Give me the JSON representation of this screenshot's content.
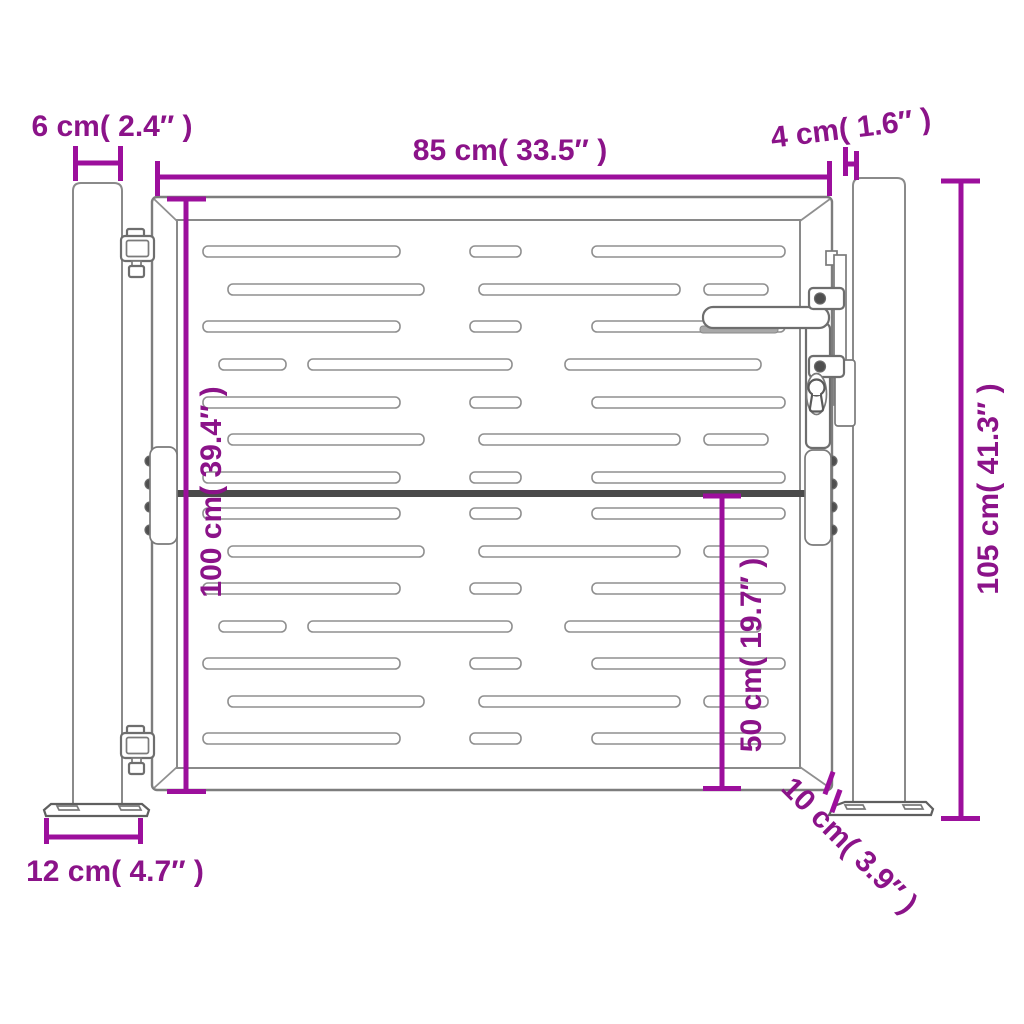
{
  "image_type": "technical dimension diagram of a metal garden gate with two posts",
  "colors": {
    "background": "#ffffff",
    "dimension_line": "#9c0f9c",
    "dimension_text": "#8b1389",
    "drawing_line": "#8a8a8a",
    "drawing_dark": "#4a4a4a"
  },
  "dimensions": {
    "post_width": "6 cm( 2.4″ )",
    "gate_width": "85 cm( 33.5″ )",
    "gate_to_post_gap": "4 cm( 1.6″ )",
    "gate_height": "100 cm( 39.4″ )",
    "post_height": "105 cm( 41.3″ )",
    "lower_section_height": "50 cm( 19.7″ )",
    "base_plate_width": "12 cm( 4.7″ )",
    "base_plate_depth": "10 cm( 3.9″ )"
  },
  "slots": {
    "height": 11,
    "types": {
      "A": [
        [
          203,
          197
        ],
        [
          470,
          51
        ],
        [
          592,
          193
        ]
      ],
      "B": [
        [
          228,
          196
        ],
        [
          479,
          201
        ],
        [
          704,
          64
        ]
      ],
      "C": [
        [
          219,
          67
        ],
        [
          308,
          204
        ],
        [
          565,
          196
        ]
      ]
    },
    "sequence": [
      "A",
      "B",
      "A",
      "C",
      "A",
      "B",
      "A"
    ],
    "row_y_upper": [
      246,
      284,
      321,
      359,
      397,
      434,
      472
    ],
    "row_y_lower": [
      508,
      546,
      583,
      621,
      658,
      696,
      733
    ]
  }
}
